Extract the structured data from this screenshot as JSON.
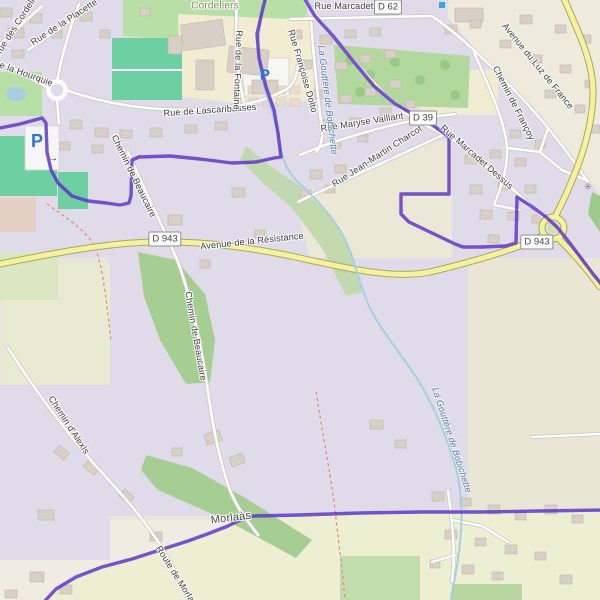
{
  "map": {
    "labels": [
      {
        "text": "Cordeliers",
        "x": 215,
        "y": 6,
        "rot": 0,
        "kind": "area"
      },
      {
        "text": "Rue des Cordeliers",
        "x": 18,
        "y": 22,
        "rot": -57,
        "kind": "road"
      },
      {
        "text": "Rue de la Placette",
        "x": 64,
        "y": 22,
        "rot": -33,
        "kind": "road"
      },
      {
        "text": "de la Hourquie",
        "x": 24,
        "y": 73,
        "rot": 20,
        "kind": "road"
      },
      {
        "text": "Rue de Lascaribasses",
        "x": 210,
        "y": 110,
        "rot": -4,
        "kind": "road"
      },
      {
        "text": "Rue de la Fontaine",
        "x": 238,
        "y": 70,
        "rot": 92,
        "kind": "road"
      },
      {
        "text": "Rue Marcadet",
        "x": 344,
        "y": 6,
        "rot": 0,
        "kind": "road"
      },
      {
        "text": "Avenue du Luz de France",
        "x": 538,
        "y": 66,
        "rot": 51,
        "kind": "road"
      },
      {
        "text": "Chemin de Françoy",
        "x": 514,
        "y": 103,
        "rot": 63,
        "kind": "road"
      },
      {
        "text": "Rue Françoise Dolto",
        "x": 303,
        "y": 71,
        "rot": 74,
        "kind": "road"
      },
      {
        "text": "Rue Maryse Vaillant",
        "x": 362,
        "y": 122,
        "rot": -9,
        "kind": "road"
      },
      {
        "text": "Rue Jean-Martin Charcot",
        "x": 377,
        "y": 156,
        "rot": -33,
        "kind": "road"
      },
      {
        "text": "Rue Marcadet Dessus",
        "x": 477,
        "y": 157,
        "rot": 41,
        "kind": "road"
      },
      {
        "text": "La Gouttère de Bobichette",
        "x": 328,
        "y": 100,
        "rot": 83,
        "kind": "water"
      },
      {
        "text": "La Gouttère de Bobichette",
        "x": 452,
        "y": 440,
        "rot": 72,
        "kind": "water"
      },
      {
        "text": "Avenue de la Résistance",
        "x": 252,
        "y": 241,
        "rot": -6,
        "kind": "road"
      },
      {
        "text": "Chemin de Beaucaire",
        "x": 134,
        "y": 176,
        "rot": 64,
        "kind": "road"
      },
      {
        "text": "Chemin de Beaucaire",
        "x": 196,
        "y": 336,
        "rot": 80,
        "kind": "road"
      },
      {
        "text": "Chemin d'Alexis",
        "x": 69,
        "y": 425,
        "rot": 57,
        "kind": "road"
      },
      {
        "text": "Morlaàs",
        "x": 231,
        "y": 518,
        "rot": -7,
        "kind": "place"
      },
      {
        "text": "Route de Morlaàs",
        "x": 178,
        "y": 578,
        "rot": 58,
        "kind": "road"
      }
    ],
    "shields": [
      {
        "text": "D 62",
        "x": 388,
        "y": 7
      },
      {
        "text": "D 39",
        "x": 423,
        "y": 118
      },
      {
        "text": "D 943",
        "x": 165,
        "y": 239
      },
      {
        "text": "D 943",
        "x": 537,
        "y": 242
      }
    ],
    "icons": [
      {
        "name": "parking-icon",
        "glyph": "P",
        "x": 265,
        "y": 75,
        "size": 15,
        "kind": "parking"
      },
      {
        "name": "parking-icon",
        "glyph": "P",
        "x": 37,
        "y": 141,
        "size": 18,
        "kind": "parking"
      },
      {
        "name": "power-pylon-icon",
        "glyph": "✳",
        "x": 588,
        "y": 188,
        "size": 10,
        "kind": "pylon"
      },
      {
        "name": "bus-stop-icon",
        "glyph": "",
        "x": 442,
        "y": 5,
        "size": 6,
        "kind": "bussq"
      },
      {
        "name": "oneway-arrow-icon",
        "glyph": "→",
        "x": 53,
        "y": 159,
        "size": 10,
        "kind": "oneway"
      }
    ],
    "colors": {
      "boundary": "#5a31c8",
      "road_major_fill": "#f4f1a0",
      "road_major_casing": "#aaa85f",
      "road_casing": "#c9c5bd",
      "water": "#a7cfe2",
      "residential": "#dfdbe8",
      "rural": "#e9e6d5",
      "farmland": "#edefd2",
      "park": "#b7dfa6",
      "pitch": "#6ecfa3",
      "wood": "#a6cd92",
      "path_red": "#e98a7e",
      "parking": "#2f6fdc",
      "building": "#d8d0c6"
    }
  }
}
